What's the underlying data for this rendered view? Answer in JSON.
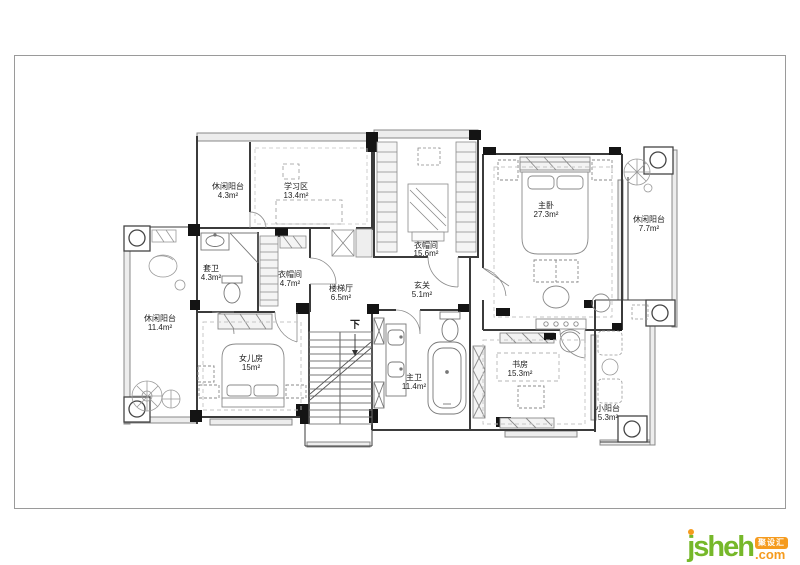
{
  "plan": {
    "stair_direction": "下",
    "rooms": [
      {
        "id": "leisure-balcony-top",
        "label": "休闲阳台",
        "area": "4.3m²"
      },
      {
        "id": "study-area",
        "label": "学习区",
        "area": "13.4m²"
      },
      {
        "id": "cloakroom-large",
        "label": "衣帽间",
        "area": "15.6m²"
      },
      {
        "id": "master-bedroom",
        "label": "主卧",
        "area": "27.3m²"
      },
      {
        "id": "leisure-balcony-right",
        "label": "休闲阳台",
        "area": "7.7m²"
      },
      {
        "id": "ensuite-bathroom",
        "label": "套卫",
        "area": "4.3m²"
      },
      {
        "id": "cloakroom-small",
        "label": "衣帽间",
        "area": "4.7m²"
      },
      {
        "id": "stair-hall",
        "label": "楼梯厅",
        "area": "6.5m²"
      },
      {
        "id": "foyer",
        "label": "玄关",
        "area": "5.1m²"
      },
      {
        "id": "leisure-balcony-left",
        "label": "休闲阳台",
        "area": "11.4m²"
      },
      {
        "id": "daughters-room",
        "label": "女儿房",
        "area": "15m²"
      },
      {
        "id": "master-bathroom",
        "label": "主卫",
        "area": "11.4m²"
      },
      {
        "id": "study-room",
        "label": "书房",
        "area": "15.3m²"
      },
      {
        "id": "small-balcony",
        "label": "小阳台",
        "area": "5.3m²"
      }
    ]
  },
  "logo": {
    "brand": "jsheh",
    "tld": ".com",
    "badge": "聚设汇"
  },
  "colors": {
    "logo_green": "#76b82a",
    "logo_orange": "#f59b1e",
    "wall": "#3b3b3b"
  }
}
